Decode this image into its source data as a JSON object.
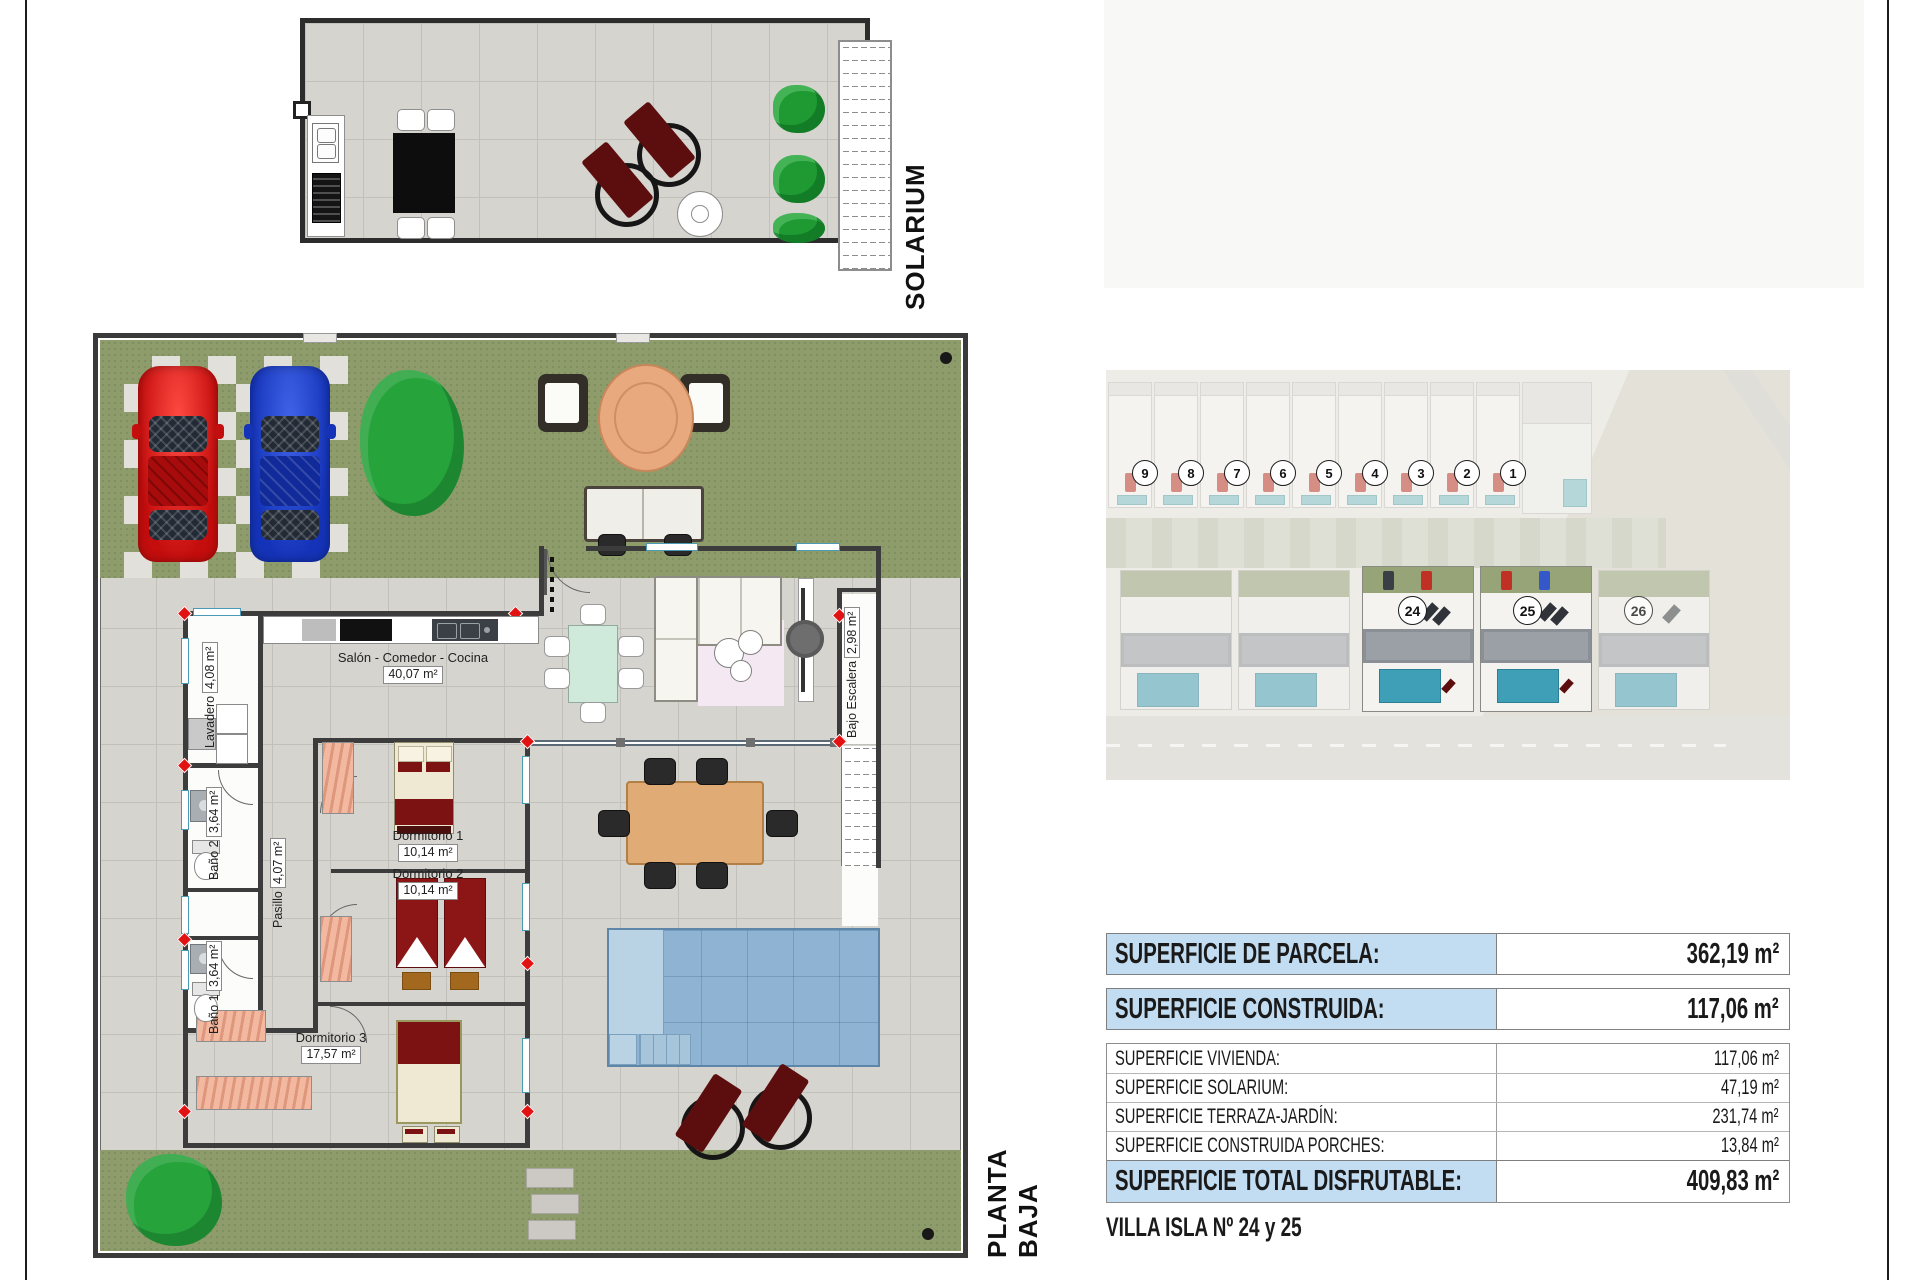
{
  "page": {
    "solarium_label": "SOLARIUM",
    "planta_baja_label": "PLANTA BAJA",
    "title": "VILLA ISLA Nº 24 y 25"
  },
  "floor_plan": {
    "rooms": [
      {
        "name": "Lavadero",
        "area": "4,08 m²"
      },
      {
        "name": "Baño 2",
        "area": "3,64 m²"
      },
      {
        "name": "Pasillo",
        "area": "4,07 m²"
      },
      {
        "name": "Baño 1",
        "area": "3,64 m²"
      },
      {
        "name": "Salón - Comedor - Cocina",
        "area": "40,07 m²"
      },
      {
        "name": "Dormitorio 1",
        "area": "10,14 m²"
      },
      {
        "name": "Dormitorio 2",
        "area": "10,14 m²"
      },
      {
        "name": "Dormitorio 3",
        "area": "17,57 m²"
      },
      {
        "name": "Bajo Escalera",
        "area": "2,98 m²"
      }
    ]
  },
  "site_photo": {
    "top_villa_numbers": [
      "9",
      "8",
      "7",
      "6",
      "5",
      "4",
      "3",
      "2",
      "1"
    ],
    "bottom_villa_numbers": [
      "24",
      "25",
      "26"
    ]
  },
  "surface_table": {
    "accent_color": "#c2dcf2",
    "highlight_rows": [
      {
        "label": "SUPERFICIE DE PARCELA:",
        "value": "362,19 m²"
      },
      {
        "label": "SUPERFICIE CONSTRUIDA:",
        "value": "117,06 m²"
      }
    ],
    "detail_rows": [
      {
        "label": "SUPERFICIE VIVIENDA:",
        "value": "117,06 m²"
      },
      {
        "label": "SUPERFICIE SOLARIUM:",
        "value": "47,19 m²"
      },
      {
        "label": "SUPERFICIE TERRAZA-JARDÍN:",
        "value": "231,74 m²"
      },
      {
        "label": "SUPERFICIE CONSTRUIDA PORCHES:",
        "value": "13,84 m²"
      }
    ],
    "total_row": {
      "label": "SUPERFICIE TOTAL DISFRUTABLE:",
      "value": "409,83 m²"
    }
  }
}
